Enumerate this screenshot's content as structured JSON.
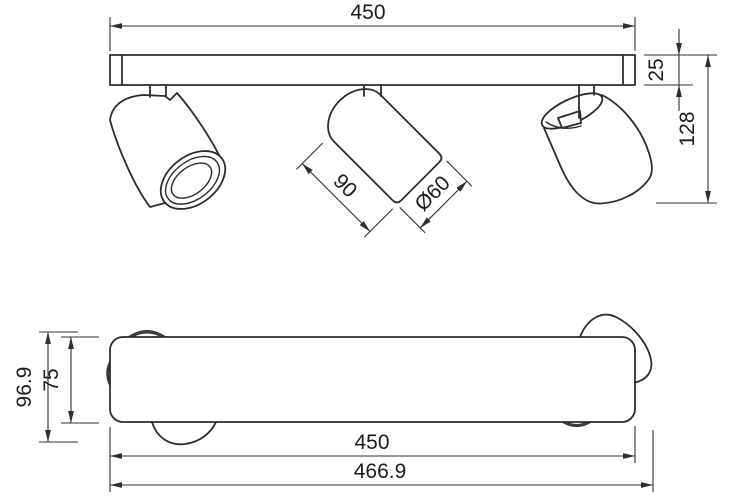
{
  "top_view": {
    "width_label": "450",
    "bar_height_label": "25",
    "total_height_label": "128",
    "spot_length_label": "90",
    "spot_diameter_label": "Ø60"
  },
  "bottom_view": {
    "total_depth_label": "96.9",
    "bar_depth_label": "75",
    "width_label": "450",
    "total_width_label": "466.9"
  },
  "colors": {
    "background": "#ffffff",
    "line": "#2d2d2d",
    "text": "#1c1c1c"
  }
}
